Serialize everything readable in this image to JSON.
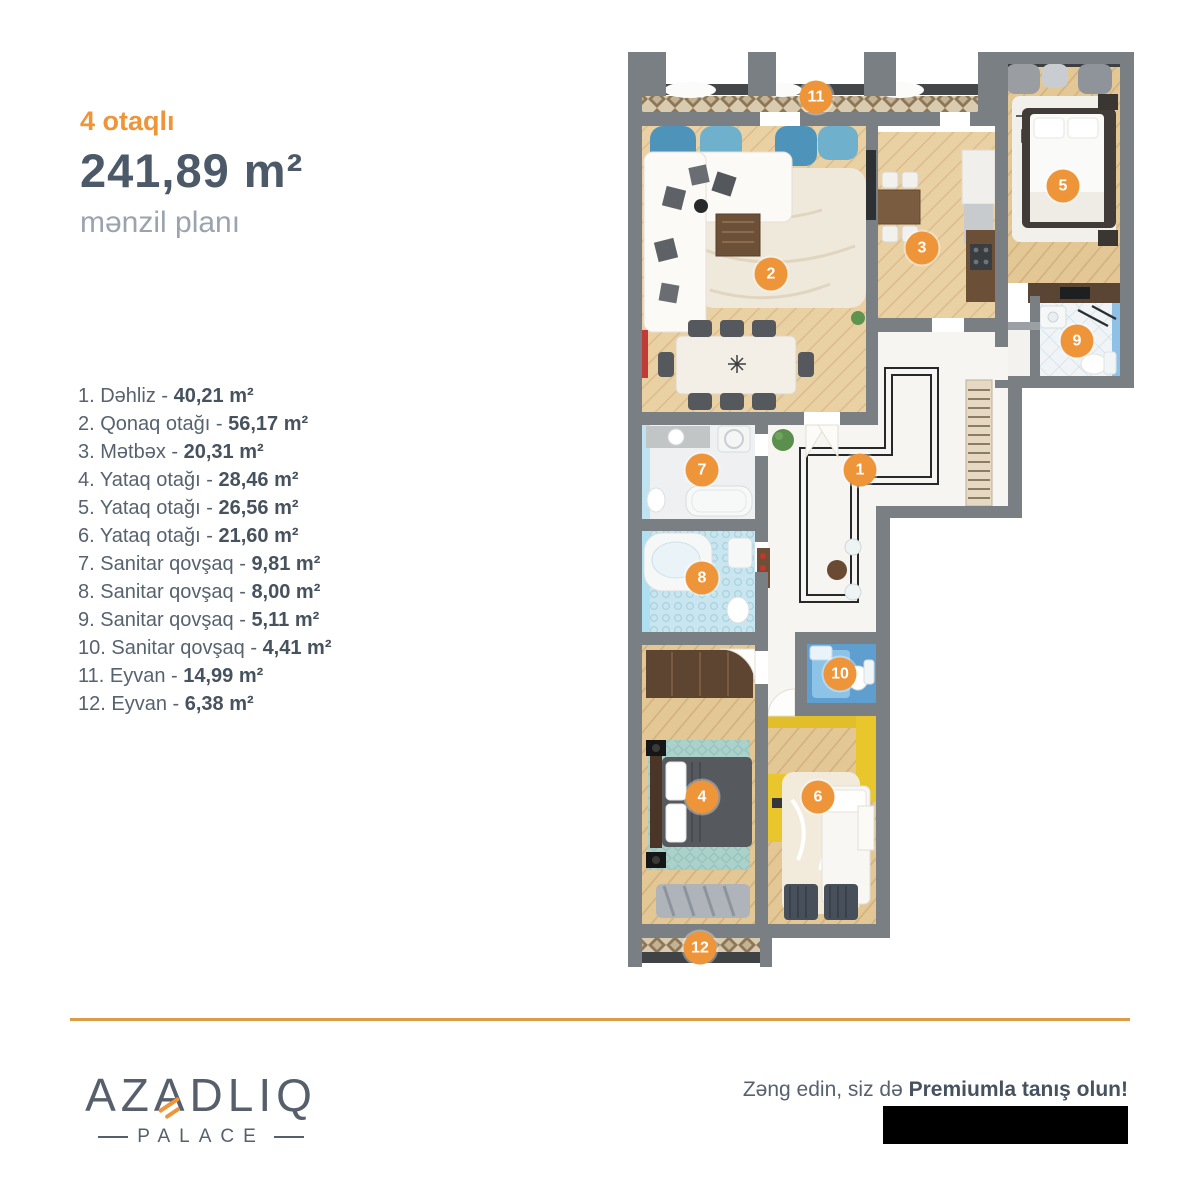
{
  "header": {
    "rooms_label": "4 otaqlı",
    "area": "241,89 m²",
    "subtitle": "mənzil planı"
  },
  "room_list": [
    {
      "num": "1.",
      "name": "Dəhliz",
      "area": "40,21 m²"
    },
    {
      "num": "2.",
      "name": "Qonaq otağı",
      "area": "56,17 m²"
    },
    {
      "num": "3.",
      "name": "Mətbəx",
      "area": "20,31 m²"
    },
    {
      "num": "4.",
      "name": "Yataq otağı",
      "area": "28,46 m²"
    },
    {
      "num": "5.",
      "name": "Yataq otağı",
      "area": "26,56 m²"
    },
    {
      "num": "6.",
      "name": "Yataq otağı",
      "area": "21,60 m²"
    },
    {
      "num": "7.",
      "name": "Sanitar qovşaq",
      "area": "9,81 m²"
    },
    {
      "num": "8.",
      "name": "Sanitar qovşaq",
      "area": "8,00 m²"
    },
    {
      "num": "9.",
      "name": "Sanitar qovşaq",
      "area": "5,11 m²"
    },
    {
      "num": "10.",
      "name": "Sanitar qovşaq",
      "area": "4,41 m²"
    },
    {
      "num": "11.",
      "name": "Eyvan",
      "area": "14,99 m²"
    },
    {
      "num": "12.",
      "name": "Eyvan",
      "area": "6,38 m²"
    }
  ],
  "plan": {
    "badges": [
      {
        "n": "1",
        "x": 860,
        "y": 470
      },
      {
        "n": "2",
        "x": 771,
        "y": 274
      },
      {
        "n": "3",
        "x": 922,
        "y": 248
      },
      {
        "n": "4",
        "x": 702,
        "y": 797
      },
      {
        "n": "5",
        "x": 1063,
        "y": 186
      },
      {
        "n": "6",
        "x": 818,
        "y": 797
      },
      {
        "n": "7",
        "x": 702,
        "y": 470
      },
      {
        "n": "8",
        "x": 702,
        "y": 578
      },
      {
        "n": "9",
        "x": 1077,
        "y": 341
      },
      {
        "n": "10",
        "x": 840,
        "y": 674
      },
      {
        "n": "11",
        "x": 816,
        "y": 97
      },
      {
        "n": "12",
        "x": 700,
        "y": 948
      }
    ]
  },
  "footer": {
    "logo_main": "AZADLIQ",
    "logo_accent_index": 2,
    "logo_sub": "PALACE",
    "cta_regular": "Zəng edin, siz də ",
    "cta_bold": "Premiumla tanış olun!"
  },
  "colors": {
    "accent_orange": "#EE9539",
    "heading_dark": "#4C5968",
    "body_text": "#57626F",
    "muted_text": "#9AA3AE",
    "value_text": "#47525F",
    "wall_gray": "#7A7F83",
    "divider_orange": "#DD9A47",
    "logo_gray": "#565F6B",
    "badge_text": "#FFFFFF"
  }
}
